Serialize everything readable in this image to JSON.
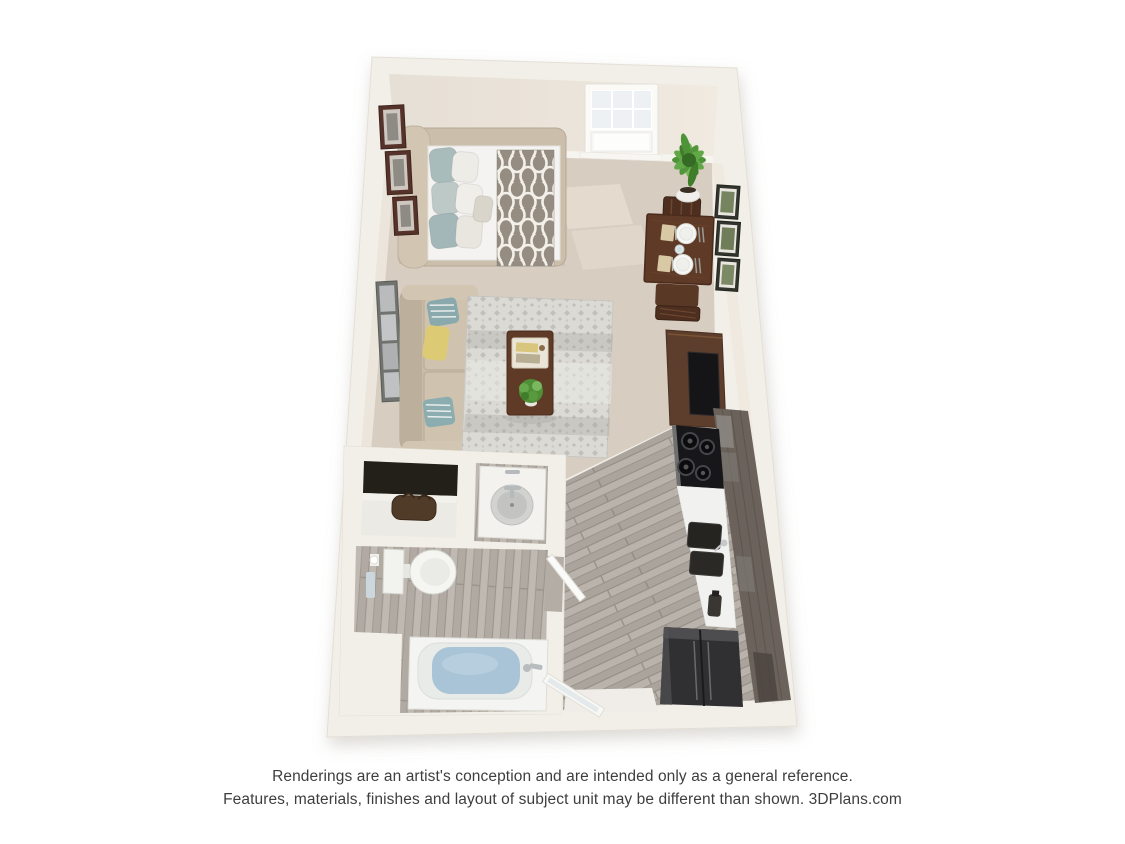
{
  "page": {
    "width": 1125,
    "height": 844,
    "background": "#ffffff"
  },
  "disclaimer": {
    "line1": "Renderings are an artist's conception and are intended only as a general reference.",
    "line2": "Features, materials, finishes and layout of subject unit may be different than shown. 3DPlans.com"
  },
  "floorplan": {
    "view": "3d-top-down-studio-apartment-rendering",
    "rooms": [
      {
        "name": "sleeping-area",
        "items": [
          "upholstered-bed",
          "pillows",
          "trellis-throw-blanket",
          "three-wall-frames"
        ]
      },
      {
        "name": "living-area",
        "items": [
          "beige-sofa",
          "teal-and-yellow-pillows",
          "area-rug",
          "coffee-table",
          "tv-stand",
          "tall-wall-art"
        ]
      },
      {
        "name": "dining-area",
        "items": [
          "dark-wood-table",
          "two-chairs",
          "two-place-settings",
          "potted-plant",
          "three-framed-prints"
        ]
      },
      {
        "name": "kitchen",
        "items": [
          "range-cooktop",
          "white-counter",
          "double-basin-sink",
          "refrigerator",
          "dark-cabinets"
        ]
      },
      {
        "name": "bathroom",
        "items": [
          "vanity-sink",
          "toilet",
          "bathtub",
          "swing-door"
        ]
      },
      {
        "name": "closet",
        "items": [
          "shelf",
          "duffel-bag"
        ]
      },
      {
        "name": "entry",
        "items": [
          "glazed-entry-door",
          "white-landing"
        ]
      }
    ],
    "colors": {
      "wall": "#f2efe9",
      "wall_face": "#e9e2d8",
      "carpet": "#d7cdc1",
      "carpet_light": "#e8dfd2",
      "wood_floor": "#b3ada5",
      "wood_floor_bath": "#b8b2aa",
      "bed_frame": "#cbbfac",
      "mattress": "#f4f3f1",
      "blanket": "#968d82",
      "pillow_teal": "#8aa9ad",
      "pillow_yellow": "#ddca75",
      "sofa": "#c8bca9",
      "rug": "#dbdad5",
      "dark_wood": "#5f3b27",
      "tv_stand": "#5d3e2c",
      "tv_black": "#151517",
      "cabinets": "#6a625b",
      "appliance_black": "#17171a",
      "fridge": "#303033",
      "counter": "#f1f1ef",
      "fixture": "#f4f4f2",
      "water": "#a9c4d7",
      "plant": "#5a9a3e",
      "door_white": "#fafaf8",
      "text": "#3e3e3e"
    }
  }
}
